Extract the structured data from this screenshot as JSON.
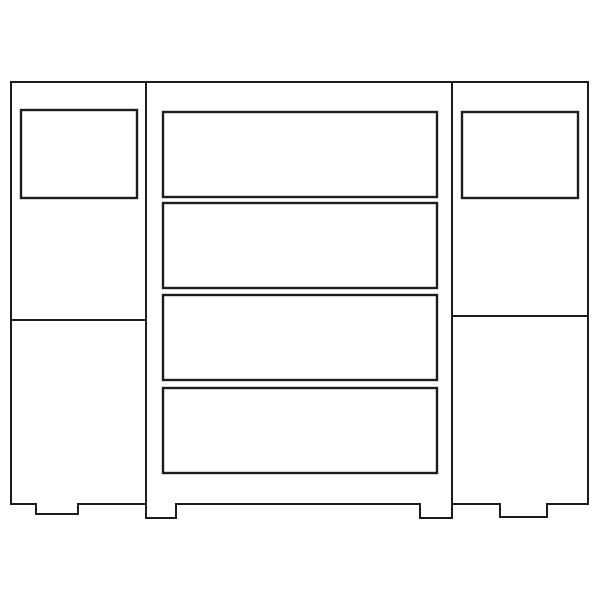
{
  "canvas": {
    "width": 600,
    "height": 600,
    "background": "#ffffff"
  },
  "style": {
    "line_color": "#1d1d1d",
    "fill_color": "#ffffff",
    "outline_stroke": 2,
    "panel_stroke": 2.4,
    "divider_stroke": 2
  },
  "drawing": {
    "sections": [
      {
        "name": "left-cabinet-outline",
        "points": [
          [
            11,
            82
          ],
          [
            146,
            82
          ],
          [
            146,
            504
          ],
          [
            78,
            504
          ],
          [
            78,
            514
          ],
          [
            36,
            514
          ],
          [
            36,
            504
          ],
          [
            11,
            504
          ]
        ]
      },
      {
        "name": "center-cabinet-outline",
        "points": [
          [
            146,
            82
          ],
          [
            452,
            82
          ],
          [
            452,
            518
          ],
          [
            420,
            518
          ],
          [
            420,
            504
          ],
          [
            176,
            504
          ],
          [
            176,
            518
          ],
          [
            146,
            518
          ]
        ]
      },
      {
        "name": "right-cabinet-outline",
        "points": [
          [
            452,
            82
          ],
          [
            588,
            82
          ],
          [
            588,
            504
          ],
          [
            547,
            504
          ],
          [
            547,
            517
          ],
          [
            500,
            517
          ],
          [
            500,
            504
          ],
          [
            452,
            504
          ]
        ]
      }
    ],
    "panels": [
      {
        "name": "left-door-panel",
        "x": 21,
        "y": 110,
        "w": 116,
        "h": 88
      },
      {
        "name": "right-door-panel",
        "x": 462,
        "y": 112,
        "w": 116,
        "h": 86
      },
      {
        "name": "drawer-1",
        "x": 163,
        "y": 112,
        "w": 274,
        "h": 85
      },
      {
        "name": "drawer-2",
        "x": 163,
        "y": 203,
        "w": 274,
        "h": 85
      },
      {
        "name": "drawer-3",
        "x": 163,
        "y": 295,
        "w": 274,
        "h": 85
      },
      {
        "name": "drawer-4",
        "x": 163,
        "y": 388,
        "w": 274,
        "h": 85
      }
    ],
    "dividers": [
      {
        "name": "left-cabinet-divider",
        "x1": 11,
        "y1": 320,
        "x2": 146,
        "y2": 320
      },
      {
        "name": "right-cabinet-divider",
        "x1": 452,
        "y1": 316,
        "x2": 588,
        "y2": 316
      }
    ]
  }
}
